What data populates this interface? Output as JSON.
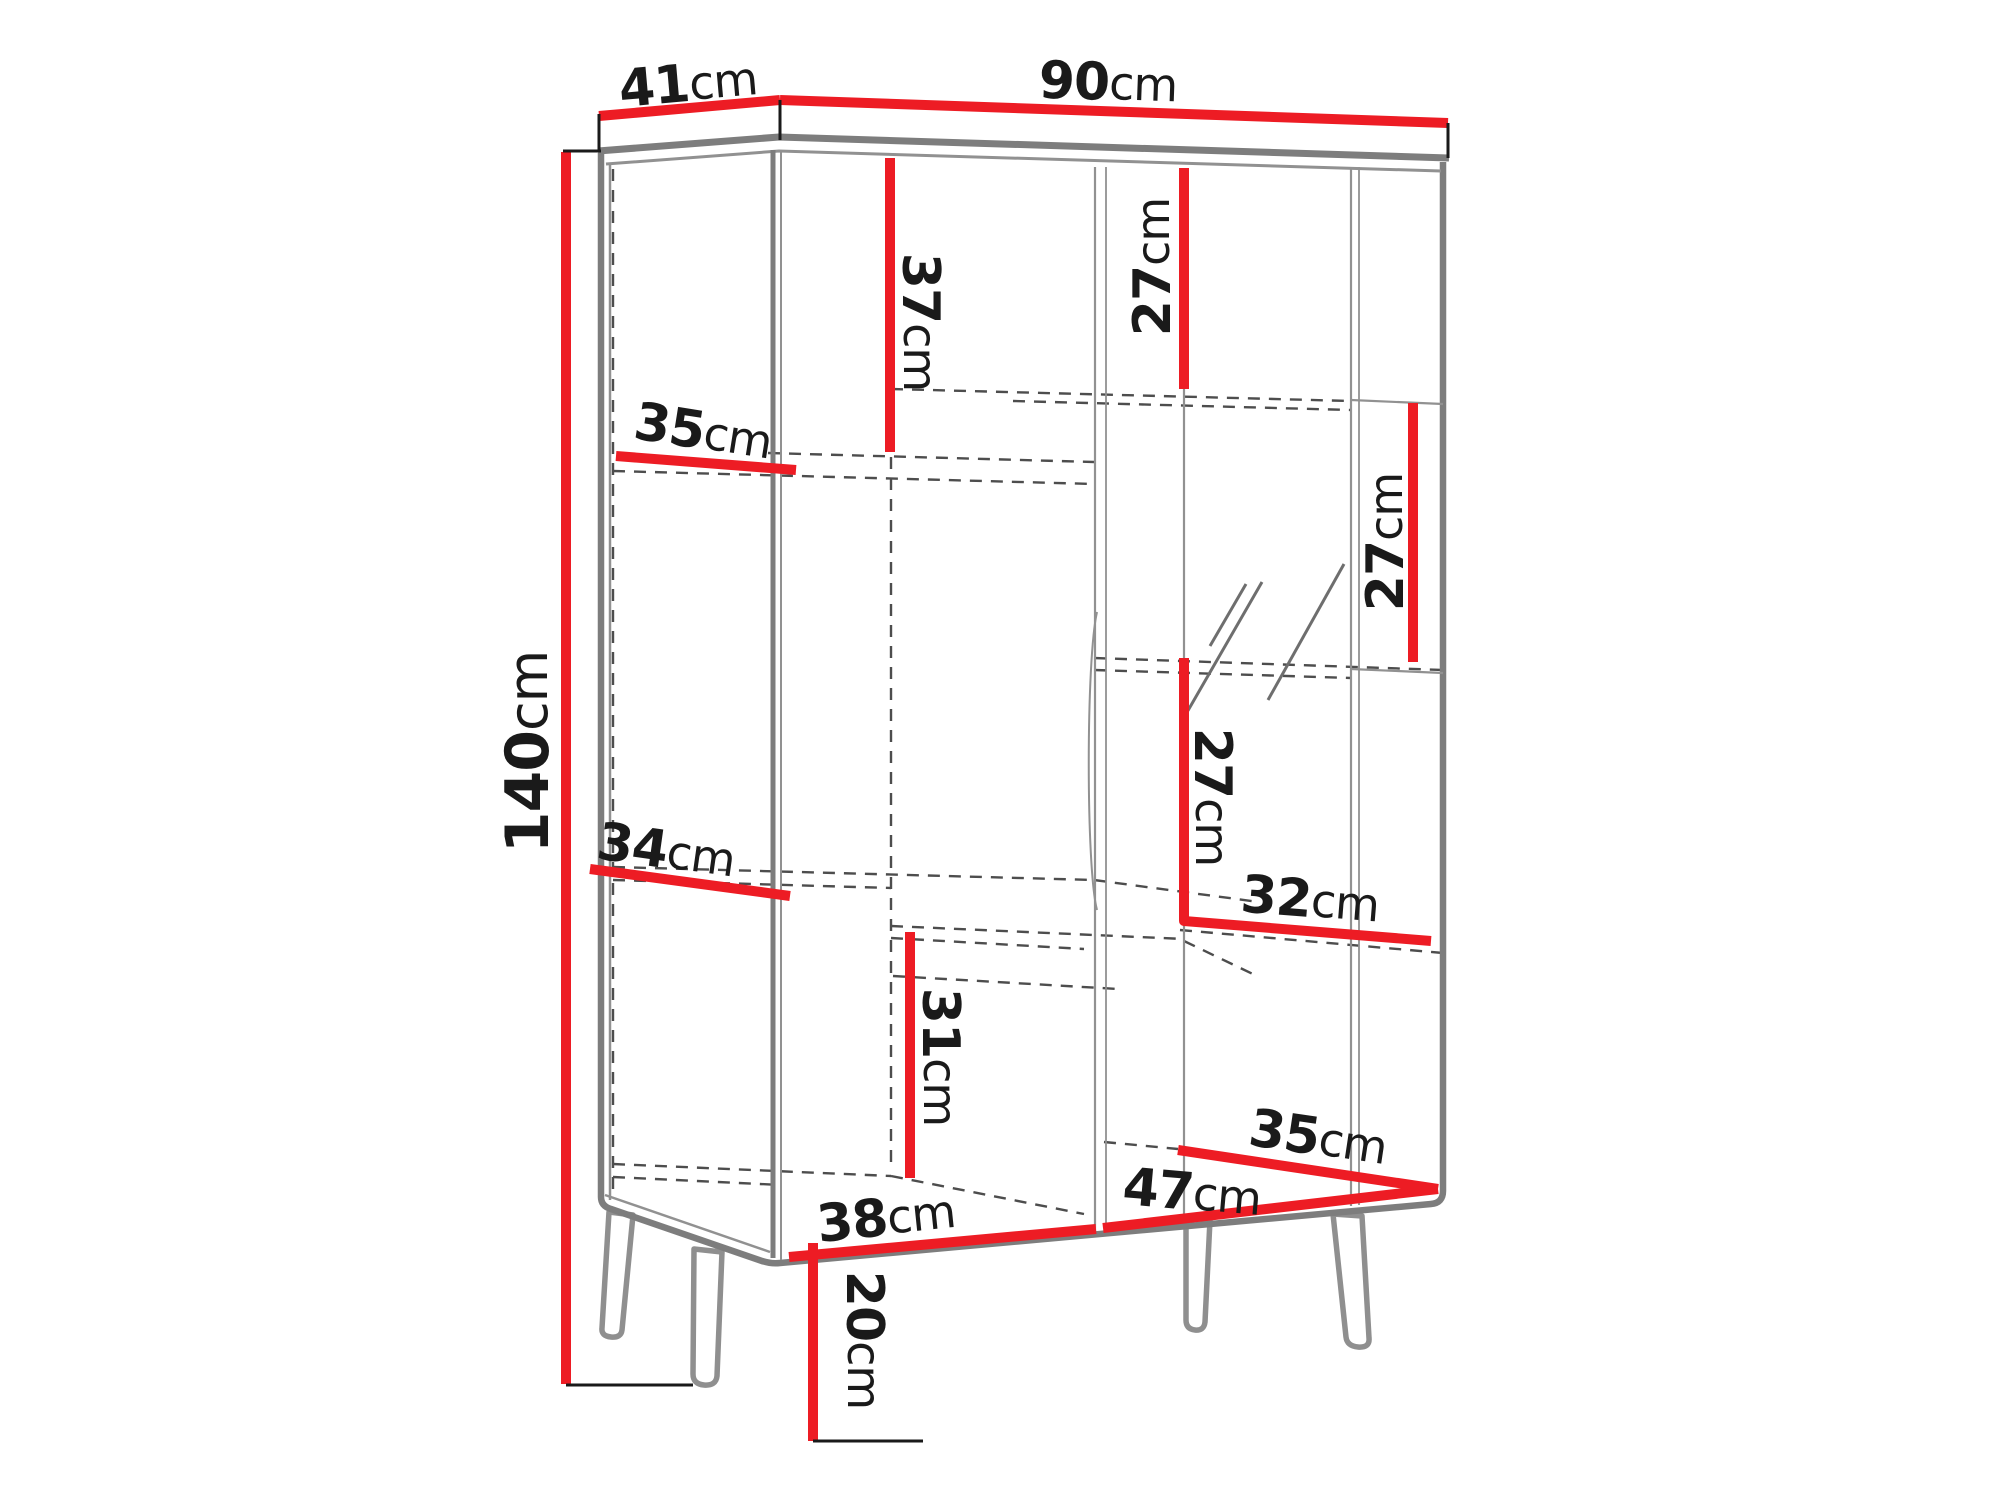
{
  "meta": {
    "type": "furniture-dimension-diagram",
    "subject": "display cabinet with legs",
    "unit": "cm"
  },
  "colors": {
    "dimension_line_red": "#ed1c24",
    "cabinet_outline_gray": "#7d7d7d",
    "interior_dashed_gray": "#4d4d4d",
    "label_black": "#1a1a1a",
    "background": "#ffffff"
  },
  "overall_dimensions": {
    "width": "90cm",
    "depth": "41cm",
    "height": "140cm",
    "leg_height": "20cm"
  },
  "labels": {
    "depth_top": {
      "value": "41",
      "unit": "cm"
    },
    "width_top": {
      "value": "90",
      "unit": "cm"
    },
    "height_left": {
      "value": "140",
      "unit": "cm"
    },
    "upper_left_section": {
      "value": "37",
      "unit": "cm"
    },
    "upper_mid_section": {
      "value": "27",
      "unit": "cm"
    },
    "upper_right_shelf": {
      "value": "27",
      "unit": "cm"
    },
    "middle_section": {
      "value": "27",
      "unit": "cm"
    },
    "left_shelf_upper": {
      "value": "35",
      "unit": "cm"
    },
    "left_shelf_lower": {
      "value": "34",
      "unit": "cm"
    },
    "right_shelf_width": {
      "value": "32",
      "unit": "cm"
    },
    "lower_mid_section": {
      "value": "31",
      "unit": "cm"
    },
    "bottom_left_width": {
      "value": "38",
      "unit": "cm"
    },
    "bottom_right_width": {
      "value": "47",
      "unit": "cm"
    },
    "bottom_right_depth": {
      "value": "35",
      "unit": "cm"
    },
    "leg_height": {
      "value": "20",
      "unit": "cm"
    }
  }
}
